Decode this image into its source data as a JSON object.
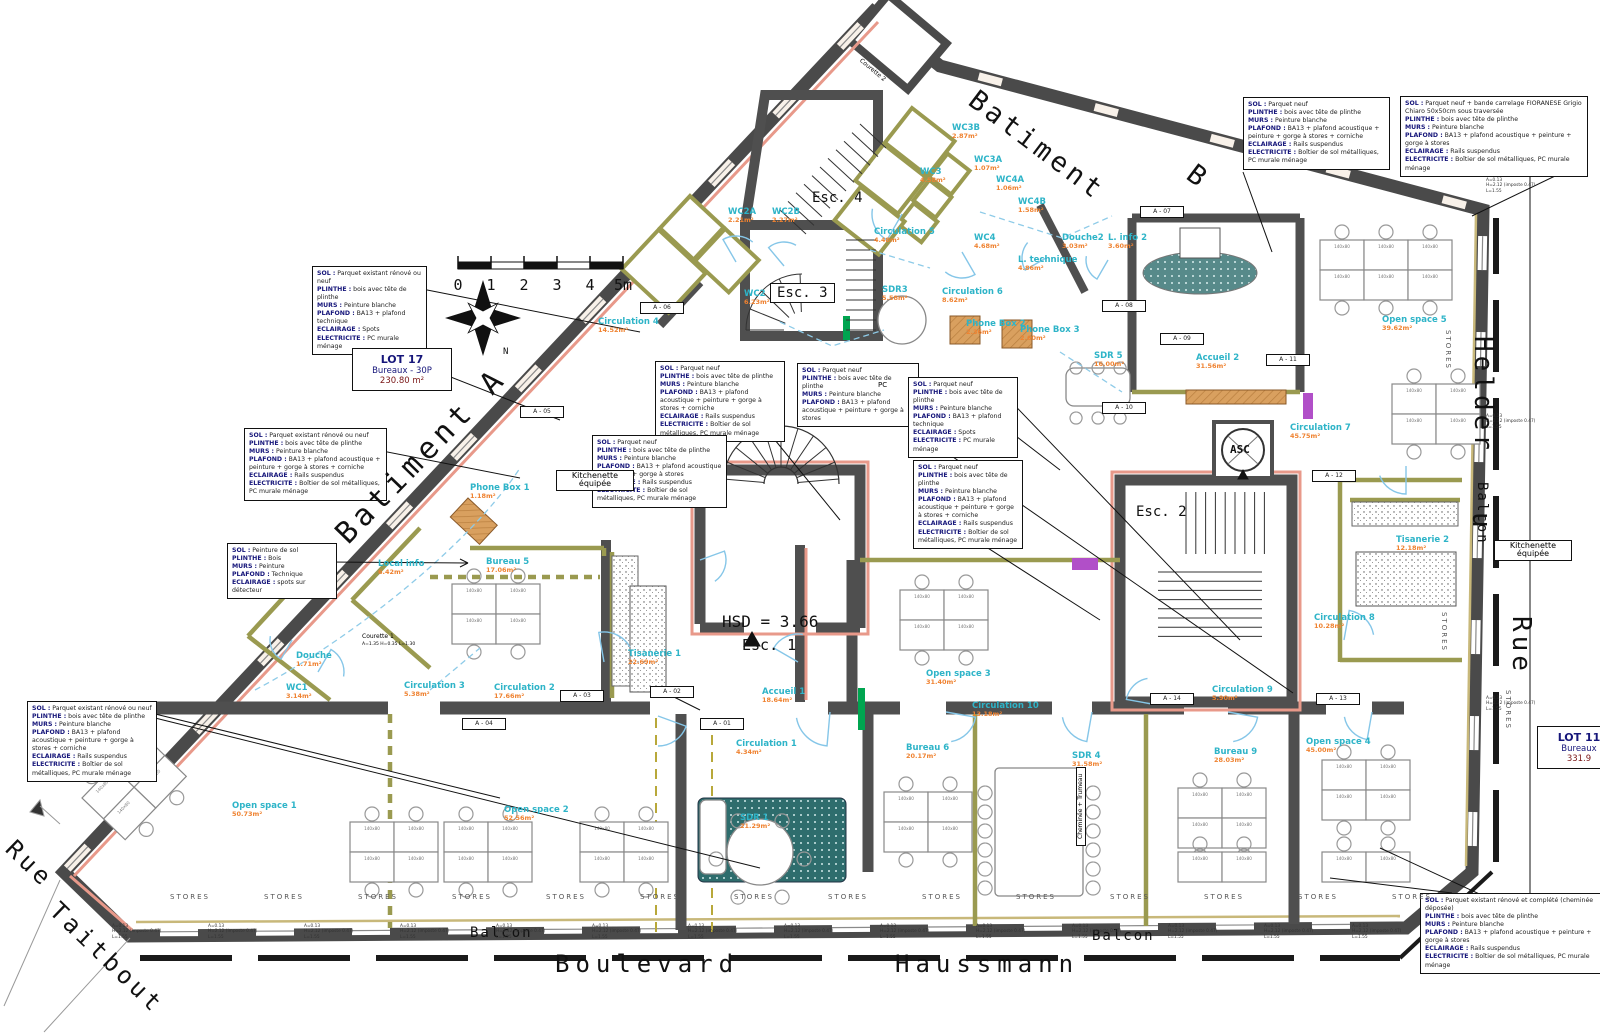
{
  "colors": {
    "wall": "#4a4a4a",
    "partition": "#9a9a50",
    "facade_accent": "#e8998a",
    "room_name": "#2eb4c8",
    "room_area": "#ef8230",
    "door_arc": "#85c6e8",
    "rug_teal": "#2e6d6d",
    "wood": "#d9a05f",
    "purple": "#b14fc8",
    "green": "#00a550",
    "spec_key": "#16167a"
  },
  "stairs": {
    "esc1": "Esc. 1",
    "esc2": "Esc. 2",
    "esc3": "Esc. 3",
    "esc4": "Esc. 4",
    "hsd": "HSD = 3.66"
  },
  "elevator": {
    "label": "ASC"
  },
  "scale_bar": {
    "ticks": [
      "0",
      "1",
      "2",
      "3",
      "4",
      "5m"
    ]
  },
  "compass": {
    "north_label": "N"
  },
  "lots": [
    {
      "id": "lot-17",
      "x": 352,
      "y": 348,
      "w": 86,
      "lines": [
        "LOT 17",
        "Bureaux - 30P",
        "230.80 m²"
      ]
    },
    {
      "id": "lot-11",
      "x": 1537,
      "y": 726,
      "w": 70,
      "lines": [
        "LOT 11",
        "Bureaux",
        "331.9"
      ]
    }
  ],
  "labels": [
    {
      "id": "street-boulevard",
      "text": "Boulevard",
      "x": 555,
      "y": 952,
      "size": 24,
      "rot": 0,
      "sp": 6,
      "cls": "hand"
    },
    {
      "id": "street-haussmann",
      "text": "Haussmann",
      "x": 895,
      "y": 952,
      "size": 24,
      "rot": 0,
      "sp": 6,
      "cls": "hand"
    },
    {
      "id": "street-rue-taitbout-1",
      "text": "Rue",
      "x": 18,
      "y": 836,
      "size": 24,
      "rot": 44,
      "sp": 4,
      "cls": "hand"
    },
    {
      "id": "street-rue-taitbout-2",
      "text": "Taitbout",
      "x": 62,
      "y": 898,
      "size": 24,
      "rot": 44,
      "sp": 4,
      "cls": "hand"
    },
    {
      "id": "street-helder",
      "text": "Helder",
      "x": 1496,
      "y": 336,
      "size": 26,
      "rot": 90,
      "sp": 4,
      "cls": "hand"
    },
    {
      "id": "street-du",
      "text": "u",
      "x": 1494,
      "y": 512,
      "size": 26,
      "rot": 90,
      "sp": 2,
      "cls": "hand"
    },
    {
      "id": "street-rue",
      "text": "Rue",
      "x": 1534,
      "y": 616,
      "size": 26,
      "rot": 90,
      "sp": 4,
      "cls": "hand"
    },
    {
      "id": "batiment-a",
      "text": "Batiment A",
      "x": 330,
      "y": 528,
      "size": 30,
      "rot": -46,
      "sp": 5,
      "cls": "hand"
    },
    {
      "id": "batiment-b-1",
      "text": "Batiment",
      "x": 980,
      "y": 86,
      "size": 27,
      "rot": 37,
      "sp": 4,
      "cls": "hand"
    },
    {
      "id": "batiment-b-2",
      "text": "B",
      "x": 1198,
      "y": 160,
      "size": 27,
      "rot": 37,
      "sp": 0,
      "cls": "hand"
    },
    {
      "id": "balcon-bottom-1",
      "text": "Balcon",
      "x": 470,
      "y": 926,
      "size": 14,
      "rot": 0,
      "sp": 2,
      "cls": "hand"
    },
    {
      "id": "balcon-bottom-2",
      "text": "Balcon",
      "x": 1092,
      "y": 929,
      "size": 14,
      "rot": 0,
      "sp": 2,
      "cls": "hand"
    },
    {
      "id": "balcon-right",
      "text": "Balcon",
      "x": 1489,
      "y": 482,
      "size": 14,
      "rot": 90,
      "sp": 2,
      "cls": "hand"
    },
    {
      "id": "kitchenette-1",
      "text": "Kitchenette équipée",
      "x": 556,
      "y": 470,
      "size": 8,
      "rot": 0,
      "sp": 0,
      "cls": "boxed",
      "w": 64
    },
    {
      "id": "kitchenette-2",
      "text": "Kitchenette équipée",
      "x": 1494,
      "y": 540,
      "size": 8,
      "rot": 0,
      "sp": 0,
      "cls": "boxed",
      "w": 64
    },
    {
      "id": "cheminee-trumeau",
      "text": "Cheminée + Trumeau",
      "x": 1076,
      "y": 846,
      "size": 6,
      "rot": -90,
      "sp": 0,
      "cls": "boxed"
    },
    {
      "id": "courette-1",
      "text": "Courette 1",
      "x": 362,
      "y": 634,
      "size": 6,
      "rot": 0,
      "sp": 0,
      "cls": ""
    },
    {
      "id": "courette-1-note",
      "text": "A=1.35  H=0.35  L=1.30",
      "x": 362,
      "y": 643,
      "size": 4.5,
      "rot": 0,
      "sp": 0,
      "cls": ""
    },
    {
      "id": "courette-2",
      "text": "Courette 2",
      "x": 862,
      "y": 58,
      "size": 6,
      "rot": 40,
      "sp": 0,
      "cls": ""
    },
    {
      "id": "pc-note",
      "text": "PC",
      "x": 878,
      "y": 382,
      "size": 7,
      "rot": 0,
      "sp": 0,
      "cls": ""
    }
  ],
  "rooms": [
    {
      "slug": "circulation-4",
      "name": "Circulation 4",
      "area": "14.52m²",
      "x": 598,
      "y": 318
    },
    {
      "slug": "bureau-5",
      "name": "Bureau 5",
      "area": "17.06m²",
      "x": 486,
      "y": 558
    },
    {
      "slug": "local-info",
      "name": "Local info",
      "area": "6.42m²",
      "x": 378,
      "y": 560
    },
    {
      "slug": "douche",
      "name": "Douche",
      "area": "1.71m²",
      "x": 296,
      "y": 652
    },
    {
      "slug": "wc1",
      "name": "WC1",
      "area": "3.14m²",
      "x": 286,
      "y": 684
    },
    {
      "slug": "circulation-3",
      "name": "Circulation 3",
      "area": "5.38m²",
      "x": 404,
      "y": 682
    },
    {
      "slug": "circulation-2",
      "name": "Circulation 2",
      "area": "17.66m²",
      "x": 494,
      "y": 684
    },
    {
      "slug": "circulation-1",
      "name": "Circulation 1",
      "area": "4.34m²",
      "x": 736,
      "y": 740
    },
    {
      "slug": "open-space-1",
      "name": "Open space 1",
      "area": "50.73m²",
      "x": 232,
      "y": 802
    },
    {
      "slug": "open-space-2",
      "name": "Open space 2",
      "area": "52.56m²",
      "x": 504,
      "y": 806
    },
    {
      "slug": "sdr-1",
      "name": "SDR 1",
      "area": "21.29m²",
      "x": 740,
      "y": 814
    },
    {
      "slug": "accueil-1",
      "name": "Accueil 1",
      "area": "18.64m²",
      "x": 762,
      "y": 688
    },
    {
      "slug": "tisanerie-1",
      "name": "Tisanerie 1",
      "area": "22.69m²",
      "x": 628,
      "y": 650
    },
    {
      "slug": "open-space-3",
      "name": "Open space 3",
      "area": "31.40m²",
      "x": 926,
      "y": 670
    },
    {
      "slug": "circulation-10",
      "name": "Circulation 10",
      "area": "13.18m²",
      "x": 972,
      "y": 702
    },
    {
      "slug": "bureau-6",
      "name": "Bureau 6",
      "area": "20.17m²",
      "x": 906,
      "y": 744
    },
    {
      "slug": "sdr-4",
      "name": "SDR 4",
      "area": "31.58m²",
      "x": 1072,
      "y": 752
    },
    {
      "slug": "bureau-9",
      "name": "Bureau 9",
      "area": "28.03m²",
      "x": 1214,
      "y": 748
    },
    {
      "slug": "open-space-4",
      "name": "Open space 4",
      "area": "45.00m²",
      "x": 1306,
      "y": 738
    },
    {
      "slug": "circulation-9",
      "name": "Circulation 9",
      "area": "5.90m²",
      "x": 1212,
      "y": 686
    },
    {
      "slug": "circulation-8",
      "name": "Circulation 8",
      "area": "10.28m²",
      "x": 1314,
      "y": 614
    },
    {
      "slug": "tisanerie-2",
      "name": "Tisanerie 2",
      "area": "12.18m²",
      "x": 1396,
      "y": 536
    },
    {
      "slug": "circulation-7",
      "name": "Circulation 7",
      "area": "45.75m²",
      "x": 1290,
      "y": 424
    },
    {
      "slug": "open-space-5",
      "name": "Open space 5",
      "area": "39.62m²",
      "x": 1382,
      "y": 316
    },
    {
      "slug": "accueil-2",
      "name": "Accueil 2",
      "area": "31.56m²",
      "x": 1196,
      "y": 354
    },
    {
      "slug": "sdr-5",
      "name": "SDR 5",
      "area": "16.00m²",
      "x": 1094,
      "y": 352
    },
    {
      "slug": "circulation-5",
      "name": "Circulation 5",
      "area": "4.48m²",
      "x": 874,
      "y": 228
    },
    {
      "slug": "circulation-6",
      "name": "Circulation 6",
      "area": "8.62m²",
      "x": 942,
      "y": 288
    },
    {
      "slug": "sdr-3",
      "name": "SDR3",
      "area": "5.58m²",
      "x": 882,
      "y": 286
    },
    {
      "slug": "wc2a",
      "name": "WC2A",
      "area": "2.21m²",
      "x": 728,
      "y": 208
    },
    {
      "slug": "wc2b",
      "name": "WC2B",
      "area": "2.27m²",
      "x": 772,
      "y": 208
    },
    {
      "slug": "wc2",
      "name": "WC2",
      "area": "6.23m²",
      "x": 744,
      "y": 290
    },
    {
      "slug": "wc3b",
      "name": "WC3B",
      "area": "2.87m²",
      "x": 952,
      "y": 124
    },
    {
      "slug": "wc3a",
      "name": "WC3A",
      "area": "1.07m²",
      "x": 974,
      "y": 156
    },
    {
      "slug": "wc3",
      "name": "WC3",
      "area": "4.58m²",
      "x": 920,
      "y": 168
    },
    {
      "slug": "wc4a",
      "name": "WC4A",
      "area": "1.06m²",
      "x": 996,
      "y": 176
    },
    {
      "slug": "wc4b",
      "name": "WC4B",
      "area": "1.58m²",
      "x": 1018,
      "y": 198
    },
    {
      "slug": "wc4",
      "name": "WC4",
      "area": "4.68m²",
      "x": 974,
      "y": 234
    },
    {
      "slug": "douche-2",
      "name": "Douche2",
      "area": "3.03m²",
      "x": 1062,
      "y": 234
    },
    {
      "slug": "l-info-2",
      "name": "L. info 2",
      "area": "3.60m²",
      "x": 1108,
      "y": 234
    },
    {
      "slug": "l-technique",
      "name": "L. technique",
      "area": "4.86m²",
      "x": 1018,
      "y": 256
    },
    {
      "slug": "phone-box-1",
      "name": "Phone Box 1",
      "area": "1.18m²",
      "x": 470,
      "y": 484
    },
    {
      "slug": "phone-box-2",
      "name": "Phone Box 2",
      "area": "2.36m²",
      "x": 966,
      "y": 320
    },
    {
      "slug": "phone-box-3",
      "name": "Phone Box 3",
      "area": "2.60m²",
      "x": 1020,
      "y": 326
    }
  ],
  "spec_boxes": [
    {
      "x": 312,
      "y": 266,
      "w": 105,
      "lines": [
        "SOL : Parquet existant rénové ou neuf",
        "PLINTHE : bois avec tête de plinthe",
        "MURS : Peinture blanche",
        "PLAFOND : BA13 + plafond technique",
        "ECLAIRAGE : Spots",
        "ELECTRICITE : PC murale ménage"
      ]
    },
    {
      "x": 244,
      "y": 428,
      "w": 133,
      "lines": [
        "SOL : Parquet existant rénové ou neuf",
        "PLINTHE : bois avec tête de plinthe",
        "MURS : Peinture blanche",
        "PLAFOND : BA13 + plafond acoustique + peinture + gorge à stores + corniche",
        "ECLAIRAGE : Rails suspendus",
        "ELECTRICITE : Boîtier de sol métalliques, PC murale ménage"
      ]
    },
    {
      "x": 227,
      "y": 543,
      "w": 100,
      "lines": [
        "SOL : Peinture de sol",
        "PLINTHE : Bois",
        "MURS : Peinture",
        "PLAFOND : Technique",
        "ECLAIRAGE : spots sur détecteur"
      ]
    },
    {
      "x": 27,
      "y": 701,
      "w": 120,
      "lines": [
        "SOL : Parquet existant rénové ou neuf",
        "PLINTHE : bois avec tête de plinthe",
        "MURS : Peinture blanche",
        "PLAFOND : BA13 + plafond acoustique + peinture + gorge à stores + corniche",
        "ECLAIRAGE : Rails suspendus",
        "ELECTRICITE : Boîtier de sol métalliques, PC murale ménage"
      ]
    },
    {
      "x": 655,
      "y": 361,
      "w": 120,
      "lines": [
        "SOL : Parquet neuf",
        "PLINTHE : bois avec tête de plinthe",
        "MURS : Peinture blanche",
        "PLAFOND : BA13 + plafond acoustique + peinture + gorge à stores + corniche",
        "ECLAIRAGE : Rails suspendus",
        "ELECTRICITE : Boîtier de sol métalliques, PC murale ménage"
      ]
    },
    {
      "x": 592,
      "y": 435,
      "w": 125,
      "lines": [
        "SOL : Parquet neuf",
        "PLINTHE : bois avec tête de plinthe",
        "MURS : Peinture blanche",
        "PLAFOND : BA13 + plafond acoustique + peinture + gorge à stores",
        "ECLAIRAGE : Rails suspendus",
        "ELECTRICITE : Boîtier de sol métalliques, PC murale ménage"
      ]
    },
    {
      "x": 797,
      "y": 363,
      "w": 112,
      "lines": [
        "SOL : Parquet neuf",
        "PLINTHE : bois avec tête de plinthe",
        "MURS : Peinture blanche",
        "PLAFOND : BA13 + plafond acoustique + peinture + gorge à stores"
      ]
    },
    {
      "x": 908,
      "y": 377,
      "w": 100,
      "lines": [
        "SOL : Parquet neuf",
        "PLINTHE : bois avec tête de plinthe",
        "MURS : Peinture blanche",
        "PLAFOND : BA13 + plafond technique",
        "ECLAIRAGE : Spots",
        "ELECTRICITE : PC murale ménage"
      ]
    },
    {
      "x": 913,
      "y": 460,
      "w": 100,
      "lines": [
        "SOL : Parquet neuf",
        "PLINTHE : bois avec tête de plinthe",
        "MURS : Peinture blanche",
        "PLAFOND : BA13 + plafond acoustique + peinture + gorge à stores + corniche",
        "ECLAIRAGE : Rails suspendus",
        "ELECTRICITE : Boîtier de sol métalliques, PC murale ménage"
      ]
    },
    {
      "x": 1243,
      "y": 97,
      "w": 137,
      "lines": [
        "SOL : Parquet neuf",
        "PLINTHE : bois avec tête de plinthe",
        "MURS : Peinture blanche",
        "PLAFOND : BA13 + plafond acoustique + peinture + gorge à stores + corniche",
        "ECLAIRAGE : Rails suspendus",
        "ELECTRICITE : Boîtier de sol métalliques, PC murale ménage"
      ]
    },
    {
      "x": 1400,
      "y": 96,
      "w": 178,
      "lines": [
        "SOL : Parquet neuf + bande carrelage FIORANESE Grigio Chiaro 50x50cm sous traversée",
        "PLINTHE : bois avec tête de plinthe",
        "MURS : Peinture blanche",
        "PLAFOND : BA13 + plafond acoustique + peinture + gorge à stores",
        "ECLAIRAGE : Rails suspendus",
        "ELECTRICITE : Boîtier de sol métalliques, PC murale ménage"
      ]
    },
    {
      "x": 1420,
      "y": 893,
      "w": 178,
      "lines": [
        "SOL : Parquet existant rénové et complété (cheminée déposée)",
        "PLINTHE : bois avec tête de plinthe",
        "MURS : Peinture blanche",
        "PLAFOND : BA13 + plafond acoustique + peinture + gorge à stores",
        "ECLAIRAGE : Rails suspendus",
        "ELECTRICITE : Boîtier de sol métalliques, PC murale ménage"
      ]
    }
  ],
  "markers": [
    {
      "label": "A - 01",
      "x": 700,
      "y": 718
    },
    {
      "label": "A - 02",
      "x": 650,
      "y": 686
    },
    {
      "label": "A - 03",
      "x": 560,
      "y": 690
    },
    {
      "label": "A - 04",
      "x": 462,
      "y": 718
    },
    {
      "label": "A - 05",
      "x": 520,
      "y": 406
    },
    {
      "label": "A - 06",
      "x": 640,
      "y": 302
    },
    {
      "label": "A - 07",
      "x": 1140,
      "y": 206
    },
    {
      "label": "A - 08",
      "x": 1102,
      "y": 300
    },
    {
      "label": "A - 09",
      "x": 1160,
      "y": 333
    },
    {
      "label": "A - 10",
      "x": 1102,
      "y": 402
    },
    {
      "label": "A - 11",
      "x": 1266,
      "y": 354
    },
    {
      "label": "A - 12",
      "x": 1312,
      "y": 470
    },
    {
      "label": "A - 13",
      "x": 1316,
      "y": 693
    },
    {
      "label": "A - 14",
      "x": 1150,
      "y": 693
    }
  ],
  "stores": {
    "text": "STORES",
    "bottom_x": [
      170,
      264,
      358,
      452,
      546,
      640,
      734,
      828,
      922,
      1016,
      1110,
      1204,
      1298,
      1392
    ],
    "bottom_y": 893,
    "side": [
      {
        "x": 1452,
        "y": 330
      },
      {
        "x": 1448,
        "y": 612
      },
      {
        "x": 1512,
        "y": 690
      }
    ]
  },
  "window_note": {
    "lines": [
      "A=0.13",
      "H=2.12 (imposte 0.47)",
      "L=1.55"
    ],
    "bottom_x": [
      112,
      208,
      304,
      400,
      496,
      592,
      688,
      784,
      880,
      976,
      1072,
      1168,
      1264,
      1352
    ],
    "bottom_y": 924,
    "side": [
      {
        "x": 1486,
        "y": 178
      },
      {
        "x": 1486,
        "y": 414
      },
      {
        "x": 1486,
        "y": 696
      }
    ]
  }
}
